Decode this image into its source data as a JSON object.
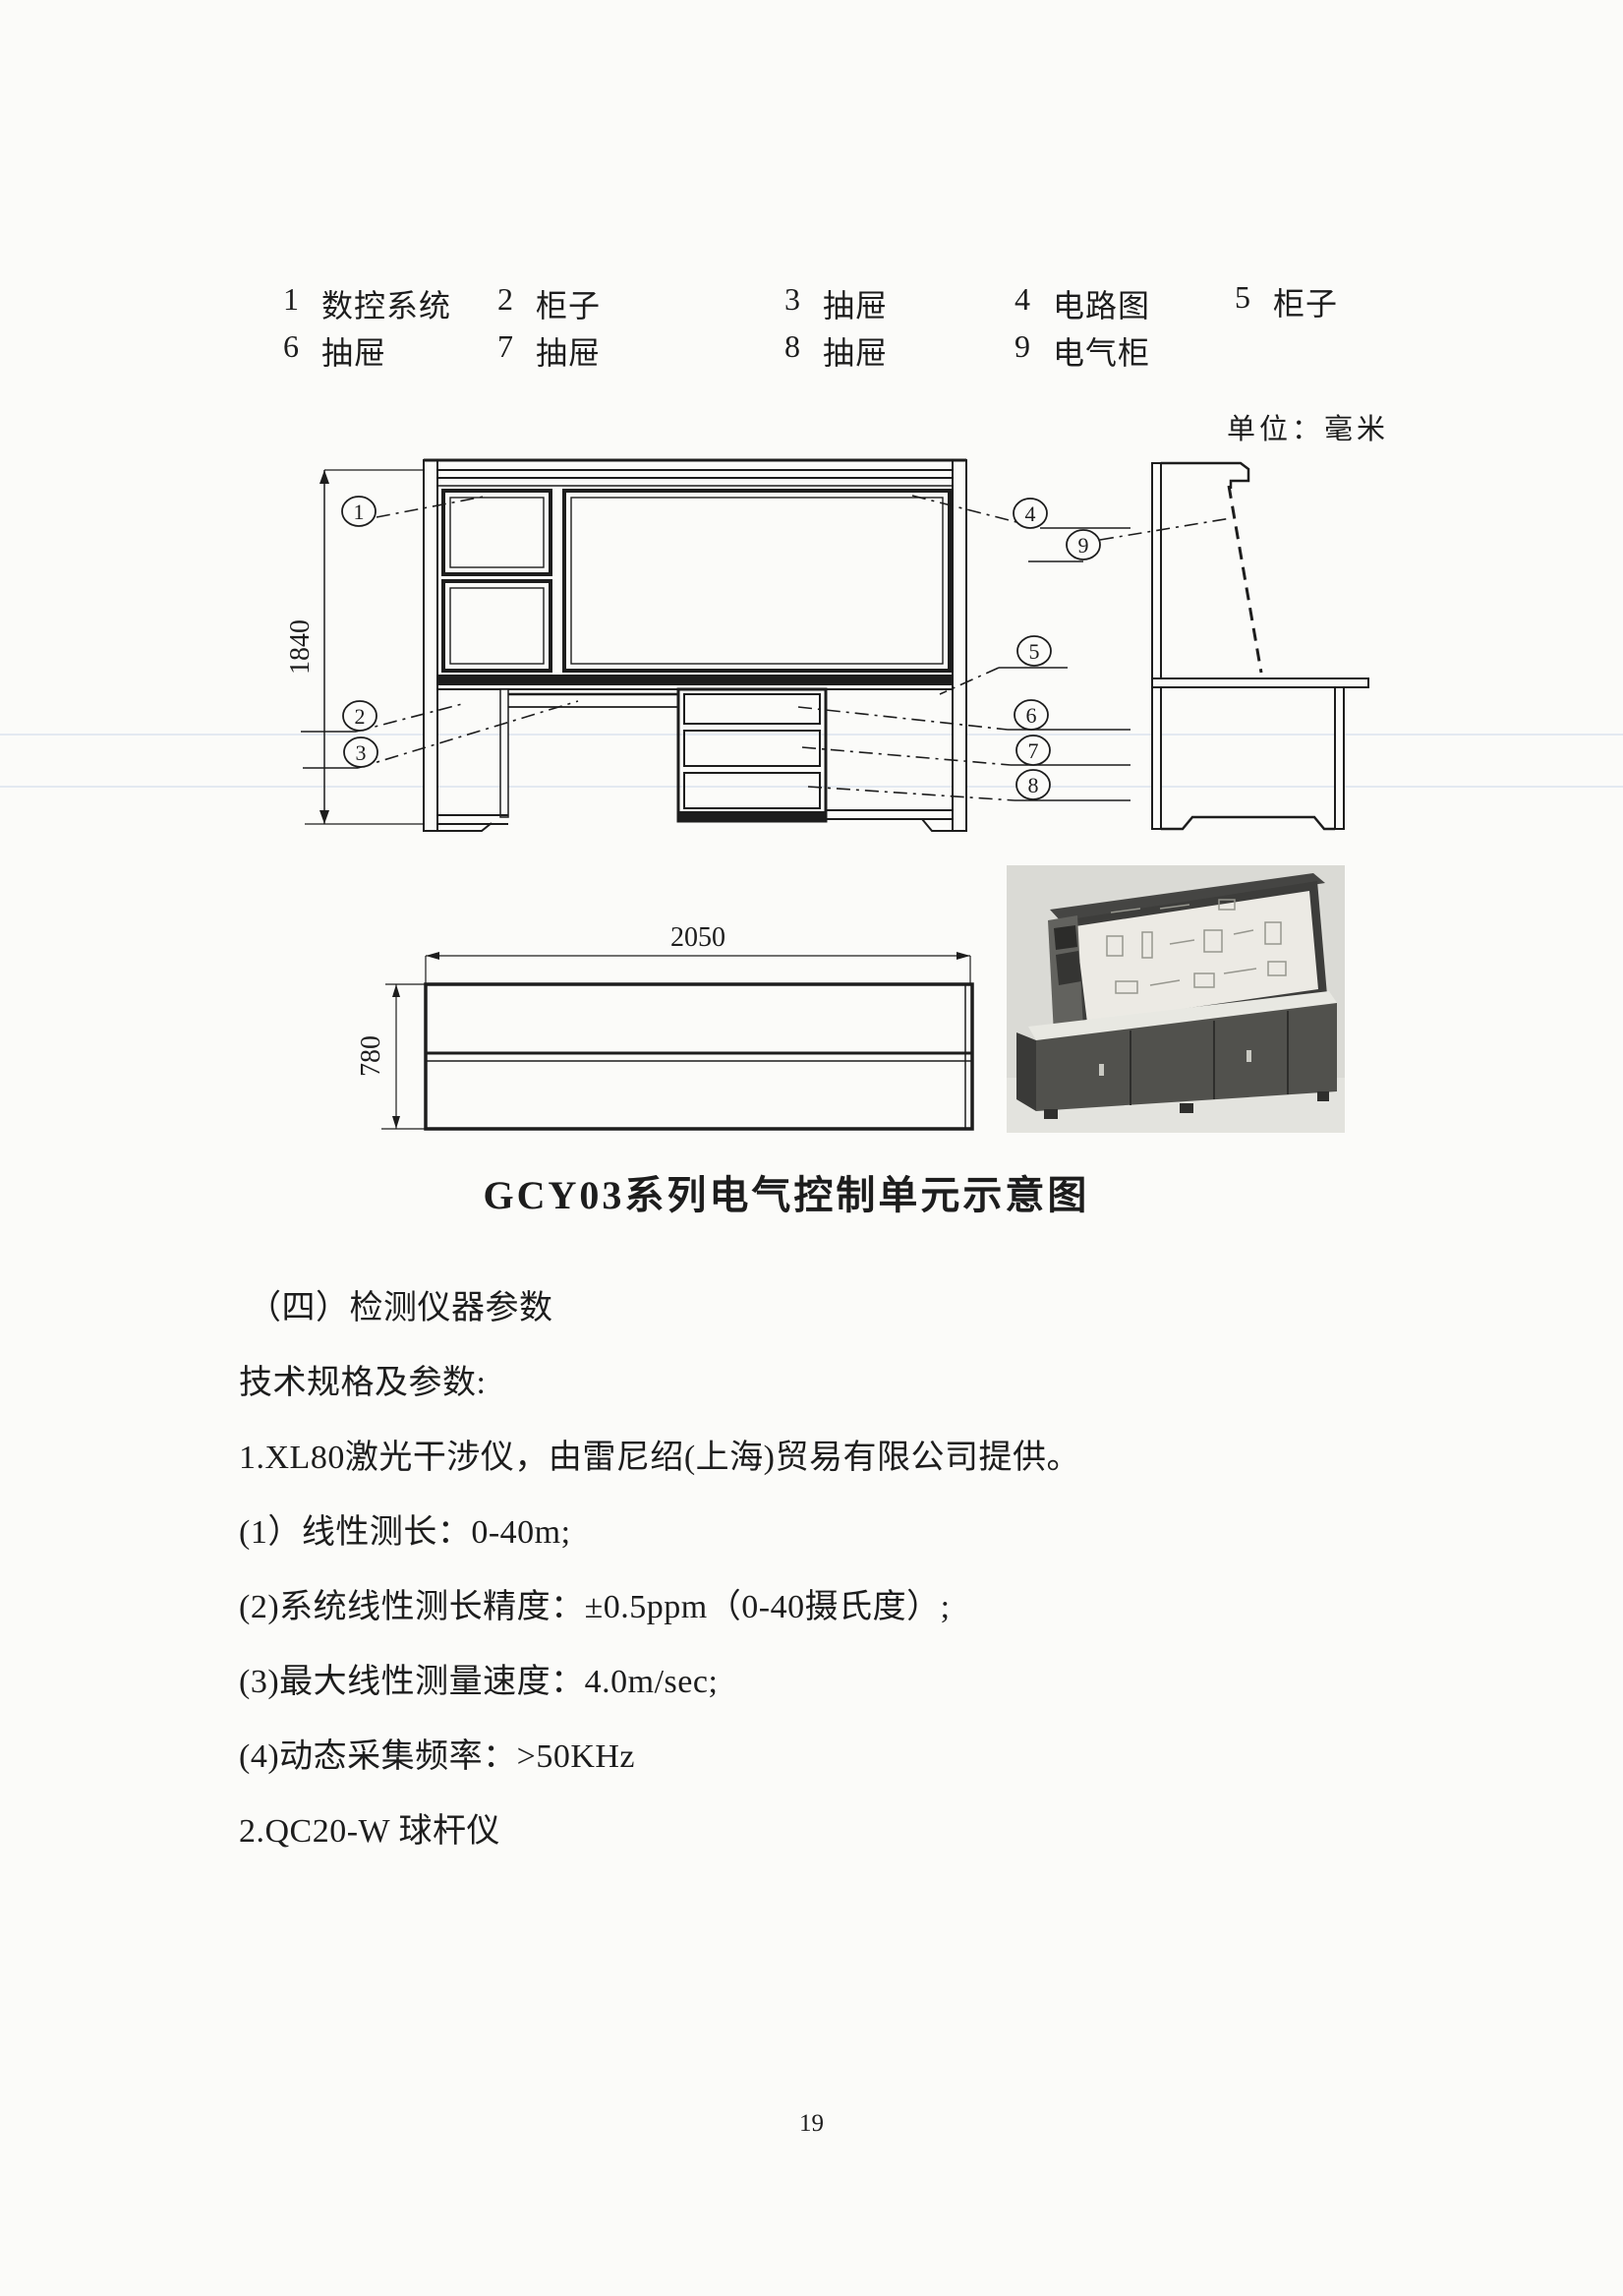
{
  "page": {
    "number": "19"
  },
  "legend": {
    "rows": [
      [
        {
          "num": "1",
          "label": "数控系统"
        },
        {
          "num": "2",
          "label": "柜子"
        },
        {
          "num": "3",
          "label": "抽屉"
        },
        {
          "num": "4",
          "label": "电路图"
        },
        {
          "num": "5",
          "label": "柜子"
        }
      ],
      [
        {
          "num": "6",
          "label": "抽屉"
        },
        {
          "num": "7",
          "label": "抽屉"
        },
        {
          "num": "8",
          "label": "抽屉"
        },
        {
          "num": "9",
          "label": "电气柜"
        }
      ]
    ]
  },
  "unit_note": "单位：毫米",
  "drawing": {
    "dim_height": "1840",
    "dim_width": "2050",
    "dim_depth": "780",
    "callouts": [
      "1",
      "2",
      "3",
      "4",
      "5",
      "6",
      "7",
      "8",
      "9"
    ]
  },
  "caption": "GCY03系列电气控制单元示意图",
  "section": {
    "heading": "（四）检测仪器参数",
    "lines": [
      "技术规格及参数:",
      "1.XL80激光干涉仪，由雷尼绍(上海)贸易有限公司提供。",
      "(1）线性测长：0-40m;",
      "(2)系统线性测长精度：±0.5ppm（0-40摄氏度）;",
      "(3)最大线性测量速度：4.0m/sec;",
      "(4)动态采集频率：>50KHz",
      "2.QC20-W 球杆仪"
    ]
  }
}
